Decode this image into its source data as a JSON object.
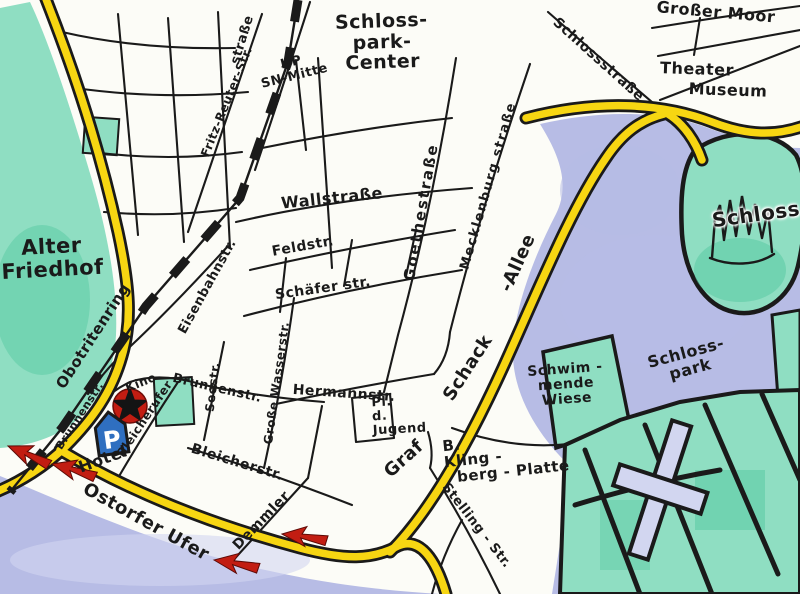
{
  "colors": {
    "paper": "#fcfcf7",
    "ink": "#1a1a1a",
    "road_yellow": "#f7d612",
    "water_blue": "#b7bce5",
    "water_light": "#d2d6f0",
    "park_green": "#8fdec2",
    "park_green_dark": "#53c8a0",
    "marker_red": "#c21d12",
    "parking_blue": "#2f6fc0"
  },
  "icons": {
    "parking_letter": "P",
    "parking_icon": "blue-p-shield",
    "hotel_marker_icon": "red-circle-black-star",
    "direction_arrow_icon": "red-route-arrow",
    "railway_icon": "dashed-railway-line",
    "castle_icon": "castle-sketch"
  },
  "labels": {
    "strasse_partial": "straße",
    "schlosspark_center": "Schloss-\npark-\nCenter",
    "hp_sn_mitte": "HP\nSN-Mitte",
    "grosser_moor": "Großer Moor",
    "theater": "Theater",
    "museum": "Museum",
    "schlossstrasse": "Schlossstraße",
    "schloss": "Schloss",
    "alter_friedhof": "Alter\nFriedhof",
    "obotritenring": "Obotritenring",
    "fritz_reuter_str": "Fritz-Reuter-Str.",
    "wallstrasse": "Wallstraße",
    "feldstr": "Feldstr.",
    "schaeferstr": "Schäfer str.",
    "goethestrasse": "Goethestraße",
    "mecklenburgstrasse": "Mecklenburg straße",
    "graf": "Graf",
    "schack": "Schack",
    "allee": "-Allee",
    "eisenbahnstr": "Eisenbahnstr.",
    "brunnenstr_upper": "Brunnenstr.",
    "brunnenstr_lower": "Brunnenstr.",
    "kino": "Kino",
    "hotel": "Hotel",
    "bleicherufer": "Bleicherufer",
    "seestr": "Seestr.",
    "grosse_wasserstr": "Große Wasserstr.",
    "bleicherstr": "Bleicherstr.",
    "hermannstr": "Hermannstr.",
    "pl_d_jugend": "Pl.\nd.\nJugend",
    "ostorfer_ufer": "Ostorfer Ufer",
    "demmler": "Demmler",
    "stelling_str": "Stelling - Str.",
    "klingberg": "B.\nKling -\n  berg - Platte",
    "schwimmende_wiese": "Schwim -\nmende\nWiese",
    "schlosspark": "Schloss-\npark"
  }
}
